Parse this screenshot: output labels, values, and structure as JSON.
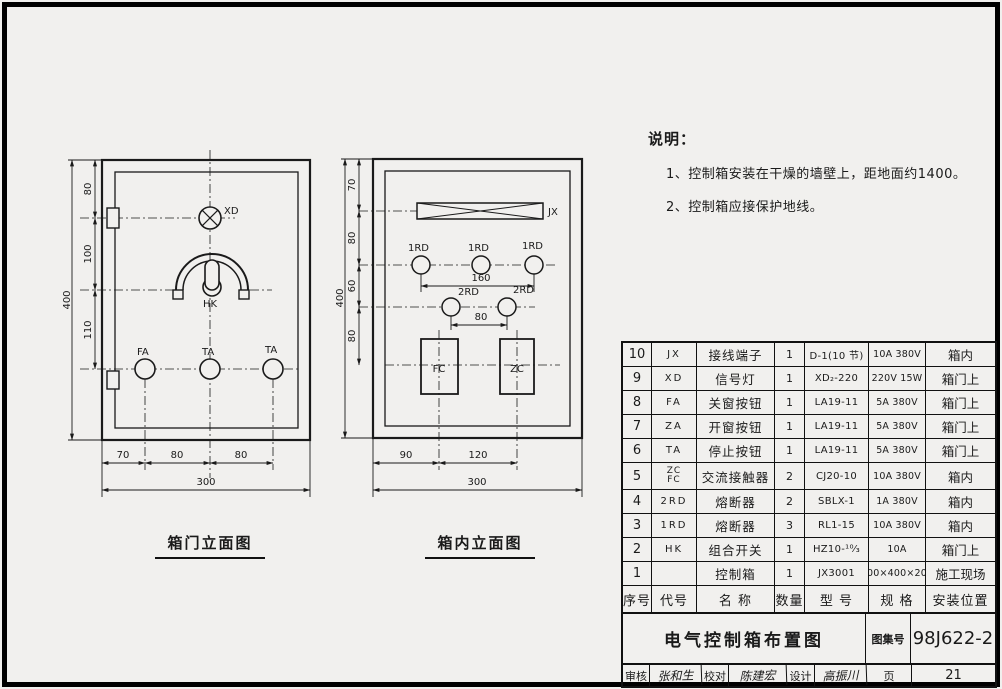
{
  "colors": {
    "line": "#1a1a1a",
    "background": "#f1f0ee"
  },
  "notes": {
    "heading": "说明：",
    "item1": "1、控制箱安装在干燥的墙壁上，距地面约1400。",
    "item2": "2、控制箱应接保护地线。"
  },
  "door": {
    "caption": "箱门立面图",
    "labels": {
      "xd": "XD",
      "hk": "HK",
      "fa": "FA",
      "ta1": "TA",
      "ta2": "TA"
    },
    "dims": {
      "v1": "80",
      "v2": "100",
      "v3": "110",
      "vtotal": "400",
      "h1": "70",
      "h2": "80",
      "h3": "80",
      "htotal": "300"
    }
  },
  "inner": {
    "caption": "箱内立面图",
    "labels": {
      "jx": "JX",
      "rd1a": "1RD",
      "rd1b": "1RD",
      "rd1c": "1RD",
      "rd2a": "2RD",
      "rd2b": "2RD",
      "fc": "FC",
      "zc": "ZC"
    },
    "dims": {
      "v1": "70",
      "v2": "80",
      "v3": "60",
      "v4": "80",
      "vtotal": "400",
      "w1": "160",
      "w2": "80",
      "h1": "90",
      "h2": "120",
      "htotal": "300"
    }
  },
  "table": {
    "headers": {
      "seq": "序号",
      "code": "代号",
      "name": "名  称",
      "qty": "数量",
      "model": "型  号",
      "spec": "规  格",
      "location": "安装位置"
    },
    "rows": [
      {
        "seq": "10",
        "code": "JX",
        "name": "接线端子",
        "qty": "1",
        "model": "D-1(10 节)",
        "spec": "10A 380V",
        "loc": "箱内"
      },
      {
        "seq": "9",
        "code": "XD",
        "name": "信号灯",
        "qty": "1",
        "model": "XD₂-220",
        "spec": "220V 15W",
        "loc": "箱门上"
      },
      {
        "seq": "8",
        "code": "FA",
        "name": "关窗按钮",
        "qty": "1",
        "model": "LA19-11",
        "spec": "5A 380V",
        "loc": "箱门上"
      },
      {
        "seq": "7",
        "code": "ZA",
        "name": "开窗按钮",
        "qty": "1",
        "model": "LA19-11",
        "spec": "5A 380V",
        "loc": "箱门上"
      },
      {
        "seq": "6",
        "code": "TA",
        "name": "停止按钮",
        "qty": "1",
        "model": "LA19-11",
        "spec": "5A 380V",
        "loc": "箱门上"
      },
      {
        "seq": "5",
        "code": "ZC\nFC",
        "name": "交流接触器",
        "qty": "2",
        "model": "CJ20-10",
        "spec": "10A 380V",
        "loc": "箱内"
      },
      {
        "seq": "4",
        "code": "2RD",
        "name": "熔断器",
        "qty": "2",
        "model": "SBLX-1",
        "spec": "1A 380V",
        "loc": "箱内"
      },
      {
        "seq": "3",
        "code": "1RD",
        "name": "熔断器",
        "qty": "3",
        "model": "RL1-15",
        "spec": "10A 380V",
        "loc": "箱内"
      },
      {
        "seq": "2",
        "code": "HK",
        "name": "组合开关",
        "qty": "1",
        "model": "HZ10-¹⁰⁄₃",
        "spec": "10A",
        "loc": "箱门上"
      },
      {
        "seq": "1",
        "code": "",
        "name": "控制箱",
        "qty": "1",
        "model": "JX3001",
        "spec": "300×400×200",
        "loc": "施工现场"
      }
    ]
  },
  "title_block": {
    "drawing_title": "电气控制箱布置图",
    "atlas_label": "图集号",
    "atlas_no": "98J622-2",
    "reviewer_label": "审核",
    "reviewer": "张和生",
    "checker_label": "校对",
    "checker": "陈建宏",
    "designer_label": "设计",
    "designer": "高振川",
    "page_label": "页",
    "page_no": "21"
  }
}
